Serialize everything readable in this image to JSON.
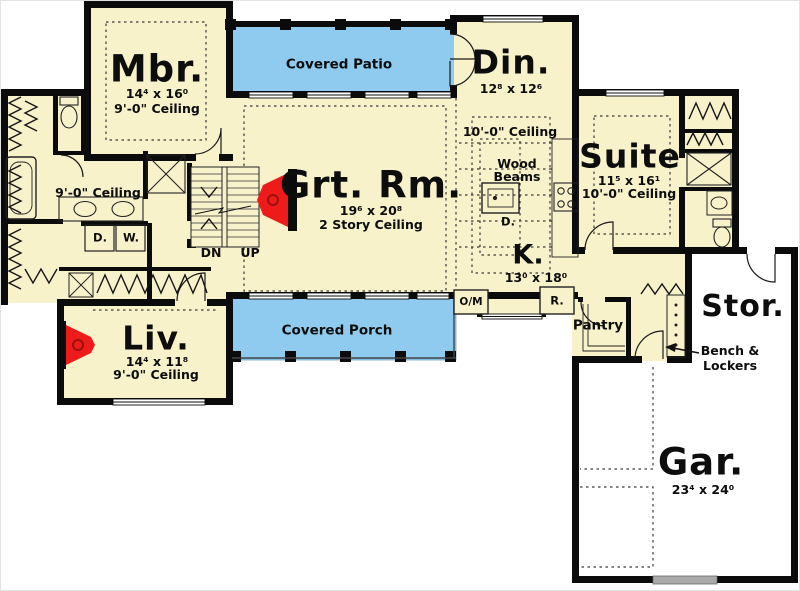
{
  "plan": {
    "rooms": {
      "mbr": {
        "name": "Mbr.",
        "dims": "14⁴ x 16⁰",
        "ceiling": "9'-0\" Ceiling"
      },
      "patio": {
        "name": "Covered Patio"
      },
      "din": {
        "name": "Din.",
        "dims": "12⁸ x 12⁶"
      },
      "grt": {
        "name": "Grt. Rm.",
        "dims": "19⁶ x 20⁸",
        "ceiling": "2 Story Ceiling"
      },
      "suite": {
        "name": "Suite",
        "dims": "11⁵ x 16¹",
        "ceiling": "10'-0\" Ceiling"
      },
      "kitchen": {
        "name": "K.",
        "dims": "13⁰ x 18⁰",
        "ceiling": "10'-0\" Ceiling",
        "wood_beams_1": "Wood",
        "wood_beams_2": "Beams",
        "island_appliance": "D."
      },
      "porch": {
        "name": "Covered Porch"
      },
      "liv": {
        "name": "Liv.",
        "dims": "14⁴ x 11⁸",
        "ceiling": "9'-0\" Ceiling"
      },
      "hall": {
        "ceiling": "9'-0\" Ceiling"
      },
      "pantry": {
        "name": "Pantry"
      },
      "stor": {
        "name": "Stor."
      },
      "gar": {
        "name": "Gar.",
        "dims": "23⁴ x 24⁰"
      }
    },
    "labels": {
      "stairs_down": "DN",
      "stairs_up": "UP",
      "dryer": "D.",
      "washer": "W.",
      "oven_microwave": "O/M",
      "refrigerator": "R.",
      "bench_1": "Bench &",
      "bench_2": "Lockers"
    },
    "colors": {
      "floor": "#F8F2CB",
      "outdoor": "#8FCBEE",
      "wall": "#0B0B0B",
      "fireplace": "#EE1B1B",
      "garage_door": "#AAAAAA"
    }
  }
}
